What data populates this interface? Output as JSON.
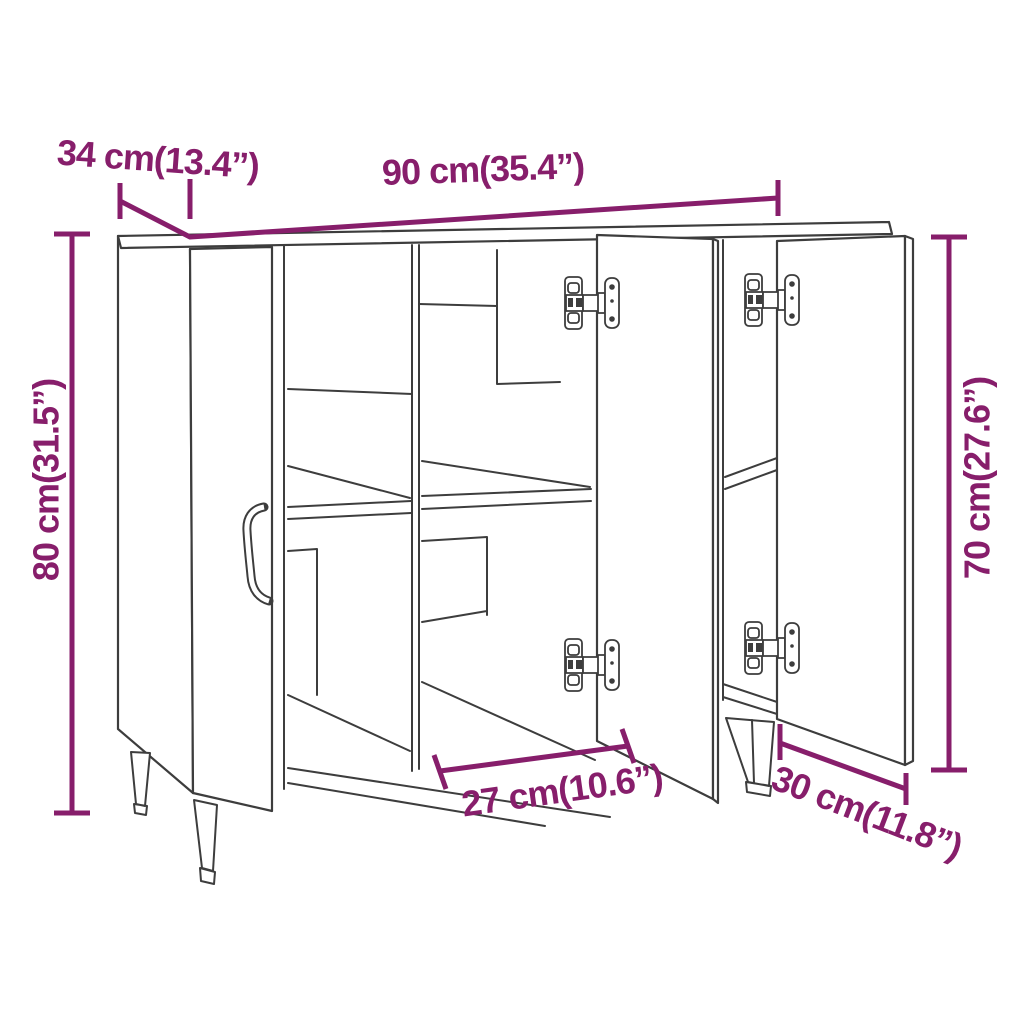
{
  "diagram": {
    "subject": "sideboard-3-door-dimension-drawing",
    "colors": {
      "dimension_accent": "#871E6B",
      "drawing_line": "#3d3d3d",
      "background": "#ffffff"
    },
    "dimensions": {
      "depth_top": {
        "label": "34 cm(13.4”)"
      },
      "width_top": {
        "label": "90 cm(35.4”)"
      },
      "height_left": {
        "label": "80 cm(31.5”)"
      },
      "height_right": {
        "label": "70 cm(27.6”)"
      },
      "compartment_bottom": {
        "label": "27 cm(10.6”)"
      },
      "door_bottom_right": {
        "label": "30 cm(11.8”)"
      }
    }
  }
}
